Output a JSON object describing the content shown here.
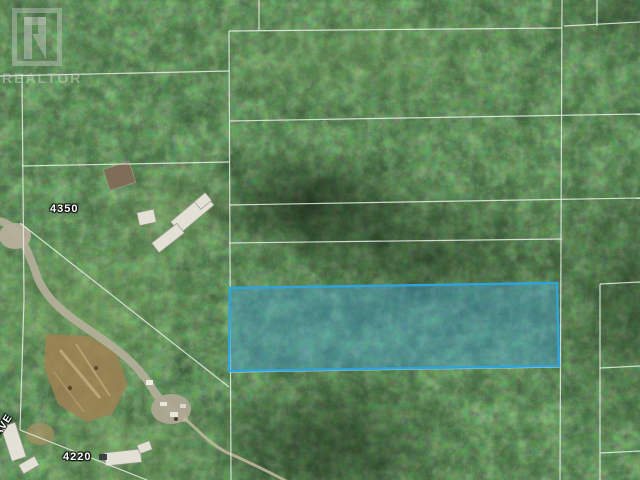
{
  "canvas": {
    "width": 640,
    "height": 480
  },
  "watermark": {
    "logo_glyph": "R",
    "label": "REALTOR"
  },
  "map": {
    "type": "aerial-parcel-photo",
    "labels": {
      "parcel_upper": "4350",
      "parcel_lower": "4220",
      "street": "NS AVE"
    },
    "highlight_parcel": {
      "points": "230,288 557,283 559,366 229,371",
      "stroke": "#2fa3dc",
      "fill": "rgba(66,158,213,0.42)",
      "stroke_width": 2.4
    },
    "boundary_lines": [
      [
        0,
        76,
        229,
        71
      ],
      [
        229,
        31,
        562,
        28
      ],
      [
        259,
        0,
        259,
        30
      ],
      [
        562,
        0,
        560,
        480
      ],
      [
        564,
        26,
        640,
        22
      ],
      [
        597,
        0,
        597,
        26
      ],
      [
        229,
        121,
        640,
        114
      ],
      [
        229,
        205,
        640,
        198
      ],
      [
        229,
        243,
        562,
        239
      ],
      [
        229,
        31,
        231,
        480
      ],
      [
        22,
        166,
        229,
        162
      ],
      [
        22,
        74,
        24,
        300
      ],
      [
        24,
        300,
        20,
        430
      ],
      [
        20,
        223,
        229,
        387
      ],
      [
        20,
        430,
        147,
        480
      ],
      [
        600,
        284,
        600,
        480
      ],
      [
        600,
        284,
        640,
        282
      ],
      [
        600,
        368,
        640,
        366
      ],
      [
        600,
        453,
        640,
        451
      ],
      [
        229,
        372,
        560,
        367
      ]
    ],
    "colors": {
      "forest_base": "#31482b",
      "boundary_line": "rgba(233,238,230,0.85)",
      "highlight_stroke": "#2fa3dc",
      "highlight_fill": "rgba(66,158,213,0.42)",
      "road": "#b6af9b",
      "cleared_land": "#9f8154",
      "building_roof": "#e3e1d6",
      "watermark_gray": "rgba(198,203,196,0.55)"
    }
  }
}
